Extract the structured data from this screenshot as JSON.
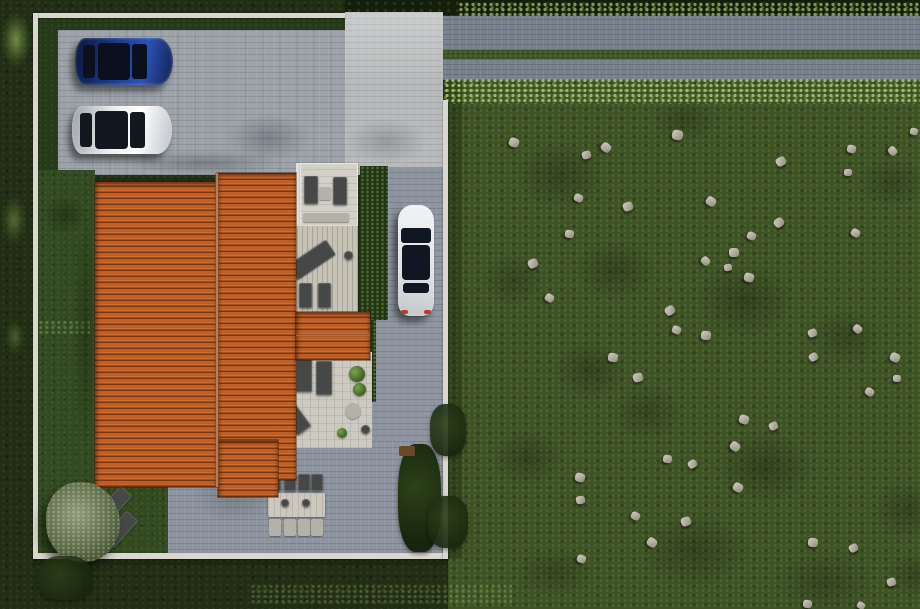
{
  "canvas": {
    "width": 920,
    "height": 609
  },
  "palette": {
    "outer_grass": "#212d15",
    "field_grass": "#3e5226",
    "lawn": "#324921",
    "driveway_pavers": "#9da3a9",
    "patio_pavers": "#8e95a0",
    "entrance_pavers": "#b7b9ba",
    "road": "#78828e",
    "road_median_grass": "#3c5124",
    "hedge": "#223416",
    "boundary_wall": "#d9d7d0",
    "roof_tile_orange": "#b55a25",
    "roof_tile_dark": "#7a3611",
    "terrace": "#d3d0c8",
    "wood_deck": "#c7c2b6",
    "furniture_dark": "#454846",
    "rock_gray": "#aaa698",
    "car_blue": "#1e3e8f",
    "car_white": "#e7e8e9",
    "car_glass": "#0c121e",
    "taillight_red": "#bb3a2e",
    "olive_tree": "#5d6c49"
  },
  "scene": {
    "items": [
      {
        "n": "base-grass",
        "c": "outer",
        "x": 0,
        "y": 0,
        "w": 920,
        "h": 609
      },
      {
        "n": "rock-field",
        "c": "field",
        "x": 448,
        "y": 78,
        "w": 472,
        "h": 531
      },
      {
        "n": "field-shadow-blob",
        "c": "blob",
        "x": 500,
        "y": 130,
        "w": 120,
        "h": 90,
        "o": 0.45
      },
      {
        "n": "field-shadow-blob",
        "c": "blob",
        "x": 560,
        "y": 230,
        "w": 110,
        "h": 80,
        "o": 0.45
      },
      {
        "n": "field-shadow-blob",
        "c": "blob",
        "x": 640,
        "y": 90,
        "w": 90,
        "h": 60,
        "o": 0.4
      },
      {
        "n": "field-shadow-blob",
        "c": "blob",
        "x": 680,
        "y": 250,
        "w": 130,
        "h": 100,
        "o": 0.5
      },
      {
        "n": "field-shadow-blob",
        "c": "blob",
        "x": 540,
        "y": 330,
        "w": 100,
        "h": 80,
        "o": 0.45
      },
      {
        "n": "field-shadow-blob",
        "c": "blob",
        "x": 700,
        "y": 420,
        "w": 130,
        "h": 95,
        "o": 0.5
      },
      {
        "n": "field-shadow-blob",
        "c": "blob",
        "x": 800,
        "y": 300,
        "w": 95,
        "h": 75,
        "o": 0.4
      },
      {
        "n": "field-shadow-blob",
        "c": "blob",
        "x": 620,
        "y": 500,
        "w": 150,
        "h": 100,
        "o": 0.45
      },
      {
        "n": "field-shadow-blob",
        "c": "blob",
        "x": 760,
        "y": 540,
        "w": 130,
        "h": 85,
        "o": 0.4
      },
      {
        "n": "field-shadow-blob",
        "c": "blob",
        "x": 860,
        "y": 470,
        "w": 95,
        "h": 80,
        "o": 0.45
      },
      {
        "n": "field-shadow-blob",
        "c": "blob",
        "x": 480,
        "y": 420,
        "w": 95,
        "h": 75,
        "o": 0.45
      },
      {
        "n": "field-shadow-blob",
        "c": "blob",
        "x": 845,
        "y": 150,
        "w": 95,
        "h": 65,
        "o": 0.4
      },
      {
        "n": "field-shadow-blob",
        "c": "blob",
        "x": 470,
        "y": 245,
        "w": 85,
        "h": 70,
        "o": 0.4
      },
      {
        "n": "field-shadow-blob",
        "c": "blob",
        "x": 875,
        "y": 545,
        "w": 85,
        "h": 60,
        "o": 0.45
      },
      {
        "n": "field-shadow-blob",
        "c": "blob",
        "x": 600,
        "y": 375,
        "w": 95,
        "h": 75,
        "o": 0.4
      },
      {
        "n": "field-shadow-blob",
        "c": "blob",
        "x": 500,
        "y": 540,
        "w": 110,
        "h": 65,
        "o": 0.4
      },
      {
        "n": "field-edge-shade",
        "c": "shade",
        "x": 448,
        "y": 80,
        "w": 14,
        "h": 478,
        "o": 0.8
      },
      {
        "n": "tree-line-top",
        "c": "darkTrees",
        "x": 345,
        "y": 0,
        "w": 575,
        "h": 15
      },
      {
        "n": "hedgerow-above-road",
        "c": "hedgerow",
        "x": 458,
        "y": 2,
        "w": 462,
        "h": 14,
        "o": 0.8
      },
      {
        "n": "road-upper-lane",
        "c": "road",
        "x": 438,
        "y": 16,
        "w": 482,
        "h": 34
      },
      {
        "n": "road-grass-median",
        "c": "median",
        "x": 438,
        "y": 50,
        "w": 482,
        "h": 9
      },
      {
        "n": "road-lower-lane",
        "c": "road",
        "x": 438,
        "y": 59,
        "w": 482,
        "h": 21
      },
      {
        "n": "hedgerow-below-road",
        "c": "hedgerow",
        "x": 438,
        "y": 78,
        "w": 482,
        "h": 26
      },
      {
        "n": "green-margin-top",
        "c": "lawnDark",
        "x": 37,
        "y": 18,
        "w": 308,
        "h": 13
      },
      {
        "n": "green-margin-left",
        "c": "lawnDark",
        "x": 37,
        "y": 18,
        "w": 21,
        "h": 154
      },
      {
        "n": "driveway-pavers",
        "c": "pavers",
        "x": 58,
        "y": 30,
        "w": 385,
        "h": 145
      },
      {
        "n": "entrance-pavers",
        "c": "entrance",
        "x": 345,
        "y": 12,
        "w": 98,
        "h": 163
      },
      {
        "n": "side-path-pavers",
        "c": "pavers2",
        "x": 388,
        "y": 167,
        "w": 55,
        "h": 156
      },
      {
        "n": "side-path-pavers",
        "c": "pavers2",
        "x": 372,
        "y": 320,
        "w": 71,
        "h": 122
      },
      {
        "n": "back-patio-pavers",
        "c": "pavers2",
        "x": 168,
        "y": 440,
        "w": 275,
        "h": 116
      },
      {
        "n": "left-lawn",
        "c": "lawn",
        "x": 37,
        "y": 170,
        "w": 58,
        "h": 317
      },
      {
        "n": "bottom-left-lawn",
        "c": "lawn",
        "x": 37,
        "y": 476,
        "w": 131,
        "h": 80
      },
      {
        "n": "lawn-bright-tufts",
        "c": "hedgerow",
        "x": 38,
        "y": 320,
        "w": 52,
        "h": 14,
        "o": 0.35
      },
      {
        "n": "house-shadow-on-driveway",
        "c": "blobGray",
        "x": 95,
        "y": 146,
        "w": 215,
        "h": 34,
        "o": 0.55
      },
      {
        "n": "tree-shadow-on-driveway",
        "c": "blobGray",
        "x": 212,
        "y": 106,
        "w": 112,
        "h": 64,
        "o": 0.5
      },
      {
        "n": "shadow-on-driveway",
        "c": "blobGray",
        "x": 330,
        "y": 110,
        "w": 112,
        "h": 62,
        "o": 0.4
      },
      {
        "n": "roof-shadow-on-lawn",
        "c": "blob",
        "x": 70,
        "y": 178,
        "w": 30,
        "h": 305,
        "o": 0.55
      },
      {
        "n": "tree-shadow-on-lawn",
        "c": "blob",
        "x": 36,
        "y": 190,
        "w": 58,
        "h": 50,
        "o": 0.6
      },
      {
        "n": "shadow-on-patio",
        "c": "blobGray",
        "x": 175,
        "y": 462,
        "w": 120,
        "h": 70,
        "o": 0.35
      },
      {
        "n": "hedge-shadow-on-path",
        "c": "blobGray",
        "x": 386,
        "y": 170,
        "w": 22,
        "h": 150,
        "o": 0.35
      },
      {
        "n": "hedge-beside-house",
        "c": "hedge",
        "x": 360,
        "y": 166,
        "w": 28,
        "h": 154
      },
      {
        "n": "hedge-beside-patio",
        "c": "hedge",
        "x": 362,
        "y": 320,
        "w": 14,
        "h": 82
      },
      {
        "n": "terrace-wall-edge",
        "c": "wallThin",
        "x": 296,
        "y": 163,
        "w": 4,
        "h": 152
      },
      {
        "n": "upper-terrace",
        "c": "terrace",
        "x": 300,
        "y": 163,
        "w": 58,
        "h": 63
      },
      {
        "n": "wood-deck",
        "c": "deck",
        "x": 292,
        "y": 226,
        "w": 66,
        "h": 89
      },
      {
        "n": "patio-wall-edge",
        "c": "wallThin",
        "x": 278,
        "y": 352,
        "w": 94,
        "h": 4
      },
      {
        "n": "lower-patio",
        "c": "patio",
        "x": 278,
        "y": 355,
        "w": 94,
        "h": 93
      },
      {
        "n": "terrace-sofa",
        "c": "furn",
        "x": 304,
        "y": 176,
        "w": 14,
        "h": 28
      },
      {
        "n": "terrace-sofa",
        "c": "furn",
        "x": 333,
        "y": 177,
        "w": 14,
        "h": 28
      },
      {
        "n": "terrace-coffee-table",
        "c": "furnLight",
        "x": 319,
        "y": 187,
        "w": 12,
        "h": 13
      },
      {
        "n": "terrace-bench",
        "c": "furnLight",
        "x": 303,
        "y": 213,
        "w": 46,
        "h": 9
      },
      {
        "n": "deck-sun-lounger",
        "c": "furn",
        "x": 303,
        "y": 237,
        "w": 18,
        "h": 46,
        "r": 56
      },
      {
        "n": "deck-chair",
        "c": "furn",
        "x": 299,
        "y": 283,
        "w": 13,
        "h": 25
      },
      {
        "n": "deck-chair",
        "c": "furn",
        "x": 318,
        "y": 283,
        "w": 13,
        "h": 25
      },
      {
        "n": "deck-planter",
        "c": "furn",
        "x": 344,
        "y": 251,
        "w": 9,
        "h": 9,
        "br": "50%"
      },
      {
        "n": "patio-chair",
        "c": "furn",
        "x": 296,
        "y": 358,
        "w": 16,
        "h": 34
      },
      {
        "n": "patio-chair",
        "c": "furn",
        "x": 316,
        "y": 361,
        "w": 16,
        "h": 34
      },
      {
        "n": "patio-plant",
        "c": "plant",
        "x": 349,
        "y": 366,
        "w": 16,
        "h": 16
      },
      {
        "n": "patio-plant",
        "c": "plant",
        "x": 353,
        "y": 383,
        "w": 13,
        "h": 13
      },
      {
        "n": "patio-sun-lounger",
        "c": "furn",
        "x": 286,
        "y": 401,
        "w": 17,
        "h": 33,
        "r": -36
      },
      {
        "n": "patio-round-table",
        "c": "furnLight",
        "x": 345,
        "y": 403,
        "w": 16,
        "h": 16,
        "br": "50%"
      },
      {
        "n": "patio-pot",
        "c": "furn",
        "x": 361,
        "y": 425,
        "w": 9,
        "h": 9,
        "br": "50%"
      },
      {
        "n": "patio-plant",
        "c": "plant",
        "x": 337,
        "y": 428,
        "w": 10,
        "h": 10
      },
      {
        "n": "dining-table",
        "c": "tableTop",
        "x": 268,
        "y": 493,
        "w": 57,
        "h": 24
      },
      {
        "n": "table-decor",
        "c": "furn",
        "x": 281,
        "y": 499,
        "w": 8,
        "h": 8,
        "br": "50%"
      },
      {
        "n": "table-decor",
        "c": "furn",
        "x": 302,
        "y": 499,
        "w": 8,
        "h": 8,
        "br": "50%"
      },
      {
        "n": "dining-chair",
        "c": "furn",
        "x": 269,
        "y": 474,
        "w": 12,
        "h": 17
      },
      {
        "n": "dining-chair",
        "c": "furn",
        "x": 284,
        "y": 474,
        "w": 12,
        "h": 17
      },
      {
        "n": "dining-chair",
        "c": "furn",
        "x": 298,
        "y": 474,
        "w": 12,
        "h": 17
      },
      {
        "n": "dining-chair",
        "c": "furn",
        "x": 311,
        "y": 474,
        "w": 12,
        "h": 17
      },
      {
        "n": "dining-chair",
        "c": "furnLight",
        "x": 269,
        "y": 519,
        "w": 12,
        "h": 17
      },
      {
        "n": "dining-chair",
        "c": "furnLight",
        "x": 284,
        "y": 519,
        "w": 12,
        "h": 17
      },
      {
        "n": "dining-chair",
        "c": "furnLight",
        "x": 298,
        "y": 519,
        "w": 12,
        "h": 17
      },
      {
        "n": "dining-chair",
        "c": "furnLight",
        "x": 311,
        "y": 519,
        "w": 12,
        "h": 17
      },
      {
        "n": "lawn-lounger",
        "c": "furn",
        "x": 106,
        "y": 486,
        "w": 16,
        "h": 37,
        "r": 42
      },
      {
        "n": "lawn-lounger",
        "c": "furn",
        "x": 112,
        "y": 511,
        "w": 16,
        "h": 37,
        "r": 42
      },
      {
        "n": "boundary-wall-top",
        "c": "wall",
        "x": 33,
        "y": 13,
        "w": 312,
        "h": 5
      },
      {
        "n": "boundary-wall-left",
        "c": "wall",
        "x": 33,
        "y": 13,
        "w": 5,
        "h": 546
      },
      {
        "n": "boundary-wall-bottom",
        "c": "wall",
        "x": 33,
        "y": 553,
        "w": 415,
        "h": 6
      },
      {
        "n": "boundary-wall-right",
        "c": "wall",
        "x": 443,
        "y": 100,
        "w": 5,
        "h": 459
      },
      {
        "n": "wall-shadow",
        "c": "shade",
        "x": 33,
        "y": 559,
        "w": 415,
        "h": 6,
        "o": 0.5
      },
      {
        "n": "roof-main-left-slope",
        "c": "roof",
        "x": 95,
        "y": 182,
        "w": 122,
        "h": 305
      },
      {
        "n": "roof-main-right-slope",
        "c": "roof",
        "x": 217,
        "y": 173,
        "w": 79,
        "h": 307
      },
      {
        "n": "roof-east-wing",
        "c": "roof",
        "x": 296,
        "y": 312,
        "w": 74,
        "h": 48
      },
      {
        "n": "roof-south-tail",
        "c": "roof",
        "x": 218,
        "y": 440,
        "w": 60,
        "h": 57
      },
      {
        "n": "roof-ridge-main",
        "c": "ridge",
        "x": 215,
        "y": 173,
        "w": 4,
        "h": 314
      },
      {
        "n": "roof-ridge-wing",
        "c": "ridgeH",
        "x": 296,
        "y": 334,
        "w": 74,
        "h": 3,
        "o": 0.7
      },
      {
        "n": "car-blue-sedan",
        "k": "car-h",
        "c": "car",
        "x": 75,
        "y": 38,
        "w": 98,
        "h": 47,
        "body": "linear-gradient(100deg,#0e1c44 5%,#1e3e8f 45%,#2b52b5 70%,#16295f 95%)",
        "glass": "#0a101e"
      },
      {
        "n": "car-white-sedan",
        "k": "car-h",
        "c": "car",
        "x": 72,
        "y": 106,
        "w": 100,
        "h": 48,
        "body": "linear-gradient(100deg,#9ea3a8,#eceeef 40%,#ffffff 65%,#c9ccd0 95%)",
        "glass": "#13171f"
      },
      {
        "n": "car-white-parked",
        "k": "car-v",
        "c": "car",
        "x": 398,
        "y": 205,
        "w": 36,
        "h": 111,
        "body": "linear-gradient(190deg,#f2f3f4,#dfe1e3 60%,#c4c7ca)",
        "glass": "#101722"
      },
      {
        "n": "shrub-inner-corner",
        "c": "shrub",
        "x": 398,
        "y": 444,
        "w": 43,
        "h": 108
      },
      {
        "n": "wood-planter",
        "x": 399,
        "y": 446,
        "w": 16,
        "h": 10,
        "bg": "#6a492b",
        "br": "2px"
      },
      {
        "n": "tree-over-wall",
        "c": "shrub",
        "x": 430,
        "y": 404,
        "w": 36,
        "h": 52,
        "o": 0.9
      },
      {
        "n": "tree-over-wall",
        "c": "shrub",
        "x": 428,
        "y": 496,
        "w": 40,
        "h": 52,
        "o": 0.9
      },
      {
        "n": "olive-tree",
        "c": "olive",
        "x": 46,
        "y": 482,
        "w": 74,
        "h": 80
      },
      {
        "n": "bush",
        "c": "bushLight",
        "x": 0,
        "y": 10,
        "w": 32,
        "h": 60,
        "o": 0.8
      },
      {
        "n": "bush",
        "c": "bushLight",
        "x": 0,
        "y": 194,
        "w": 28,
        "h": 52,
        "o": 0.5
      },
      {
        "n": "bush",
        "c": "bushLight",
        "x": 4,
        "y": 318,
        "w": 22,
        "h": 38,
        "o": 0.4
      },
      {
        "n": "shrub-outer",
        "c": "shrub",
        "x": 38,
        "y": 556,
        "w": 54,
        "h": 44,
        "o": 0.8
      },
      {
        "n": "hedgerow-outer-bottom",
        "c": "hedgerow",
        "x": 250,
        "y": 584,
        "w": 262,
        "h": 20,
        "o": 0.3
      }
    ],
    "rocks": [
      [
        509,
        138,
        10,
        20
      ],
      [
        582,
        151,
        9,
        -15
      ],
      [
        601,
        143,
        10,
        40
      ],
      [
        672,
        130,
        11,
        10
      ],
      [
        776,
        157,
        10,
        -30
      ],
      [
        847,
        145,
        9,
        15
      ],
      [
        888,
        147,
        9,
        50
      ],
      [
        844,
        169,
        8,
        0
      ],
      [
        574,
        194,
        9,
        25
      ],
      [
        623,
        202,
        10,
        -20
      ],
      [
        706,
        197,
        10,
        35
      ],
      [
        565,
        230,
        9,
        10
      ],
      [
        774,
        218,
        10,
        -40
      ],
      [
        747,
        232,
        9,
        20
      ],
      [
        729,
        248,
        10,
        0
      ],
      [
        851,
        229,
        9,
        30
      ],
      [
        528,
        259,
        10,
        -25
      ],
      [
        701,
        257,
        9,
        45
      ],
      [
        744,
        273,
        10,
        15
      ],
      [
        724,
        264,
        8,
        -10
      ],
      [
        545,
        294,
        9,
        30
      ],
      [
        665,
        306,
        10,
        -35
      ],
      [
        672,
        326,
        9,
        20
      ],
      [
        701,
        331,
        10,
        5
      ],
      [
        808,
        329,
        9,
        -20
      ],
      [
        853,
        325,
        9,
        40
      ],
      [
        608,
        353,
        10,
        10
      ],
      [
        809,
        353,
        9,
        -30
      ],
      [
        890,
        353,
        10,
        25
      ],
      [
        633,
        373,
        10,
        -15
      ],
      [
        865,
        388,
        9,
        35
      ],
      [
        893,
        375,
        8,
        0
      ],
      [
        739,
        415,
        10,
        20
      ],
      [
        769,
        422,
        9,
        -25
      ],
      [
        730,
        442,
        10,
        40
      ],
      [
        663,
        455,
        9,
        10
      ],
      [
        688,
        460,
        9,
        -35
      ],
      [
        575,
        473,
        10,
        15
      ],
      [
        733,
        483,
        10,
        30
      ],
      [
        576,
        496,
        9,
        -10
      ],
      [
        631,
        512,
        9,
        25
      ],
      [
        681,
        517,
        10,
        -20
      ],
      [
        647,
        538,
        10,
        35
      ],
      [
        808,
        538,
        10,
        5
      ],
      [
        849,
        544,
        9,
        -30
      ],
      [
        577,
        555,
        9,
        20
      ],
      [
        887,
        578,
        9,
        -15
      ],
      [
        803,
        600,
        9,
        10
      ],
      [
        857,
        602,
        8,
        30
      ],
      [
        910,
        128,
        8,
        15
      ]
    ]
  }
}
